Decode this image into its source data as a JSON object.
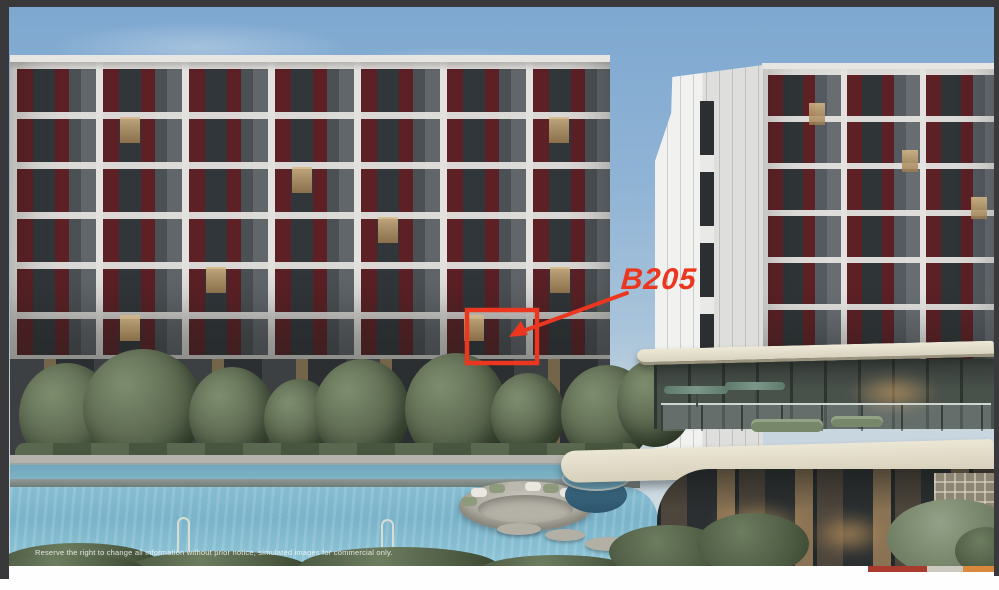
{
  "annotation": {
    "unit_label": "B205",
    "color": "#ec3720"
  },
  "footer": {
    "disclaimer": "Reserve the right to change all information without prior notice, simulated images for commercial only.",
    "accent_bar": {
      "red": "#a93a2e",
      "gray": "#ccc9c1",
      "orange": "#d8893c"
    }
  },
  "frame": {
    "border_color": "#39393b"
  }
}
